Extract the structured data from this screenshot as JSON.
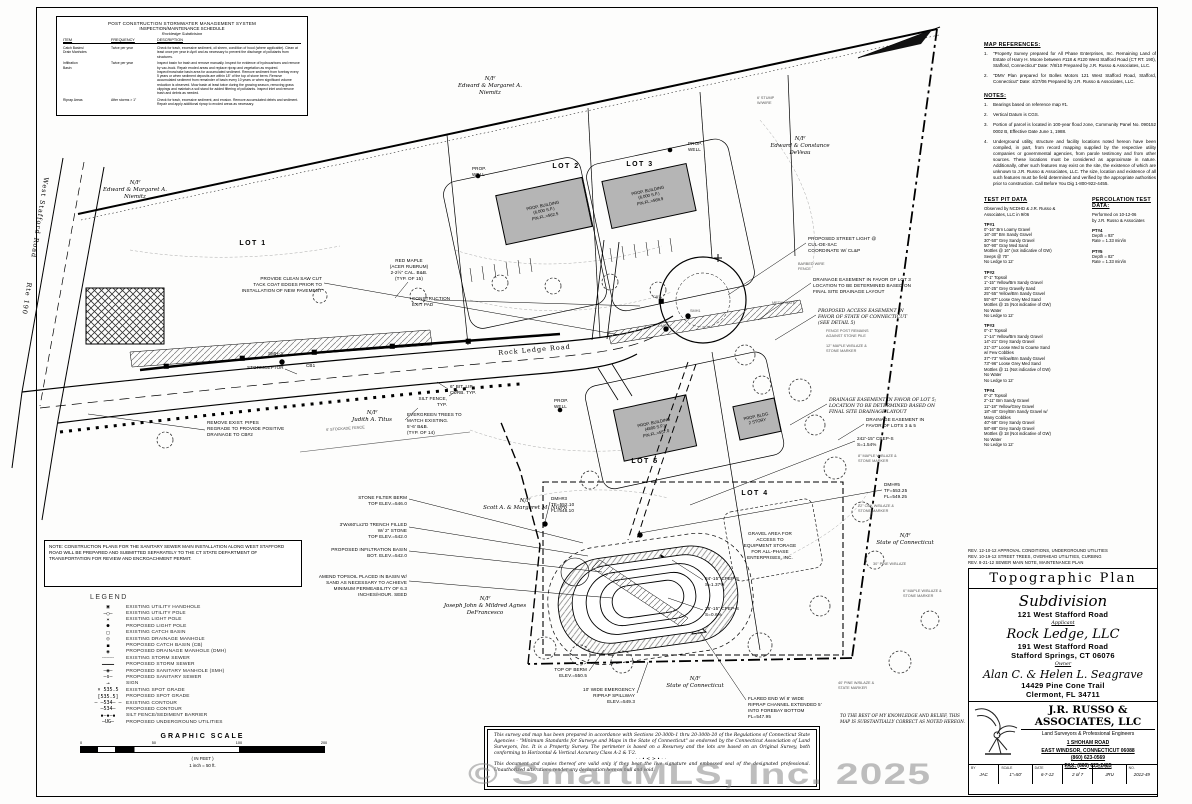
{
  "watermark": "© SmartMLS, Inc. 2025",
  "maintenance_table": {
    "title1": "POST CONSTRUCTION STORMWATER MANAGEMENT SYSTEM",
    "title2": "INSPECTION/MAINTENANCE SCHEDULE",
    "title3": "Rockledge Subdivision",
    "headers": [
      "ITEM",
      "FREQUENCY",
      "DESCRIPTION"
    ],
    "rows": [
      {
        "item": "Catch Basins/\nDrain Manholes",
        "frequency": "Twice per year",
        "description": "Check for trash, excessive sediment, oil sheen, condition of hood (where applicable). Clean at least once per year in April and as necessary to prevent the discharge of pollutants from structures."
      },
      {
        "item": "Infiltration\nBasin",
        "frequency": "Twice per year",
        "description": "Inspect basin for trash and remove manually. Inspect for evidence of hydrocarbons and remove by vac-truck. Repair eroded areas and replace riprap and vegetation as required. Inspect/mow/rake basin area for accumulated sediment. Remove sediment from forebay every 5 years or when sediment deposits are within 18\" of the top of stone berm. Remove accumulated sediment from remainder of basin every 10 years or when significant volume reduction is observed. Mow basin at least twice during the growing season, removing grass clippings and maintain a soil stand for added filtering of pollutants. Inspect inlet and remove trash and debris as needed."
      },
      {
        "item": "Riprap Areas",
        "frequency": "After storms > 1\"",
        "description": "Check for trash, excessive sediment, and erosion. Remove accumulated debris and sediment. Repair and apply additional riprap to eroded areas as necessary."
      }
    ]
  },
  "map_references": {
    "title": "MAP REFERENCES:",
    "items": [
      "\"Property Survey prepared for All Phase Enterprises, Inc. Remaining Land of Estate of Harry H. Moore between #118 & #120 West Stafford Road (CT RT. 190), Stafford, Connecticut\"  Date: 7/8/10  Prepared by J.R. Russo & Associates, LLC.",
      "\"DMV Plan prepared for Bolles Motors 121 West Stafford Road, Stafford, Connecticut\"  Date: 4/27/06  Prepared by J.R. Russo & Associates, LLC."
    ]
  },
  "notes": {
    "title": "NOTES:",
    "items": [
      "Bearings based on reference map #1.",
      "Vertical Datum is CGS.",
      "Portion of parcel is located in 100-year flood zone, Community Panel No. 090152 0002 B, Effective Date June 1, 1988.",
      "Underground utility, structure and facility locations noted hereon have been compiled, in part, from record mapping supplied by the respective utility companies or governmental agencies, from parole testimony and from other sources.  These locations must be considered as approximate in nature.  Additionally, other such features may exist on the site, the existence of which are unknown to J.R. Russo & Associates, LLC.  The size, location and existence of all such features must be field determined and verified by the appropriate authorities prior to construction.  Call Before You Dig 1-800-922-4455."
    ]
  },
  "test_pit": {
    "title": "TEST PIT DATA",
    "intro": "Observed by NCDHD & J.R. Russo &\nAssociates, LLC in 9/06",
    "pits": [
      {
        "name": "TP#1",
        "lines": "0\"-16\"  Brn Loamy Gravel\n16\"-30\"  Brn Sandy Gravel\n30\"-50\"  Grey Sandy Gravel\n50\"-90\"  Gray Med Sand\nMottles @ 16\" (not indicative of GW)\nSeeps @ 70\"\nNo Ledge to 12'"
      },
      {
        "name": "TP#2",
        "lines": "0\"-1\"  Topsoil\n1\"-15\"  Yellow/Brn Sandy Gravel\n15\"-25\"  Grey Gravelly Sand\n25\"-55\"  Yellow/Brn Sandy Gravel\n55\"-87\"  Loose Grey Med Sand\nMottles @ 15 (Not indicative of GW)\nNo Water\nNo Ledge to 12'"
      },
      {
        "name": "TP#3",
        "lines": "0\"-1\"  Topsoil\n1\"-14\"  Yellow/Brn Sandy Gravel\n14\"-21\"  Grey Sandy Gravel\n21\"-37\"  Loose Med to Coarse Sand\n           w/ Few Cobbles\n37\"-73\"  Yellow/Brn Sandy Gravel\n73\"-96\"  Loose Grey Med Sand\nMottles @ 11 (Not indicative of GW)\nNo Water\nNo Ledge to 12'"
      },
      {
        "name": "TP#4",
        "lines": "0\"-2\"  Topsoil\n2\"-11\"  Brn Sandy Gravel\n11\"-18\"  Yellow/Grey Gravel\n18\"-40\"  Grey/Brn Sandy Gravel w/\n           Many Cobbles\n40\"-58\"  Grey Sandy Gravel\n58\"-88\"  Grey Sandy Gravel\nMottles @ 18 (Not indicative of GW)\nNo Water\nNo Ledge to 12'"
      }
    ]
  },
  "perc_test": {
    "title": "PERCOLATION TEST DATA:",
    "intro": "Performed on 10-12-06\nby J.R. Russo & Associates",
    "tests": [
      {
        "name": "PT#4",
        "lines": "Depth = 93\"\nRate = 1.33 min/in"
      },
      {
        "name": "PT#5",
        "lines": "Depth = 82\"\nRate = 1.33 min/in"
      }
    ]
  },
  "revisions": [
    "REV. 12-10-12   APPROVAL CONDITIONS, UNDERGROUND UTILITIES",
    "REV. 10-19-12   STREET TREES, OVERHEAD UTILITIES, CURBING",
    "REV. 8-21-12   SEWER MAIN NOTE, MAINTENANCE PLAN"
  ],
  "title_block": {
    "plan_type": "Topographic Plan",
    "subdivision": "Subdivision",
    "address": "121 West Stafford Road",
    "applicant_label": "Applicant",
    "applicant_name": "Rock Ledge, LLC",
    "applicant_addr1": "191 West Stafford Road",
    "applicant_addr2": "Stafford Springs, CT 06076",
    "owner_label": "Owner",
    "owner_name": "Alan C. & Helen L. Seagrave",
    "owner_addr1": "14429 Pine Cone Trail",
    "owner_addr2": "Clermont, FL 34711",
    "firm_name": "J.R. RUSSO & ASSOCIATES, LLC",
    "firm_sub": "Land Surveyors & Professional Engineers",
    "firm_addr1": "1 SHOHAM ROAD",
    "firm_addr2": "EAST WINDSOR, CONNECTICUT 06088",
    "firm_phone": "(860) 623-0569",
    "firm_fax": "FAX: (860) 623-2485",
    "fields": [
      {
        "label": "BY",
        "value": "JAC"
      },
      {
        "label": "SCALE",
        "value": "1\"=50'"
      },
      {
        "label": "DATE",
        "value": "6-7-12"
      },
      {
        "label": "SHEET",
        "value": "2 of 7"
      },
      {
        "label": "CHECKED",
        "value": "JRU"
      },
      {
        "label": "NO.",
        "value": "2012-49"
      }
    ]
  },
  "note_box": "NOTE:  CONSTRUCTION PLANS FOR THE SANITARY SEWER MAIN INSTALLATION ALONG WEST STAFFORD ROAD WILL BE PREPARED AND SUBMITTED SEPARATELY TO THE CT STATE DEPARTMENT OF TRANSPORTATION FOR REVIEW AND ENCROACHMENT PERMIT.",
  "legend": {
    "title": "LEGEND",
    "items": [
      {
        "sym": "▣",
        "label": "EXISTING UTILITY HANDHOLE"
      },
      {
        "sym": "—○—",
        "label": "EXISTING UTILITY POLE"
      },
      {
        "sym": "✶",
        "label": "EXISTING LIGHT POLE"
      },
      {
        "sym": "●",
        "label": "PROPOSED LIGHT POLE"
      },
      {
        "sym": "□",
        "label": "EXISTING CATCH BASIN"
      },
      {
        "sym": "◎",
        "label": "EXISTING DRAINAGE MANHOLE"
      },
      {
        "sym": "◼",
        "label": "PROPOSED CATCH BASIN (CB)"
      },
      {
        "sym": "◉",
        "label": "PROPOSED DRAINAGE MANHOLE (DMH)"
      },
      {
        "sym": "┄┄┄┄",
        "label": "EXISTING STORM SEWER"
      },
      {
        "sym": "━━━━",
        "label": "PROPOSED STORM SEWER"
      },
      {
        "sym": "—◉—",
        "label": "PROPOSED SANITARY MANHOLE (SMH)"
      },
      {
        "sym": "—s—",
        "label": "PROPOSED SANITARY SEWER"
      },
      {
        "sym": "⊸",
        "label": "SIGN"
      },
      {
        "sym": "× 535.5",
        "label": "EXISTING SPOT GRADE"
      },
      {
        "sym": "[535.5]",
        "label": "PROPOSED SPOT GRADE"
      },
      {
        "sym": "–  –534–  –",
        "label": "EXISTING CONTOUR"
      },
      {
        "sym": "—534—",
        "label": "PROPOSED CONTOUR"
      },
      {
        "sym": "▪—▪—▪",
        "label": "SILT FENCE/SEDIMENT BARRIER"
      },
      {
        "sym": "—UG—",
        "label": "PROPOSED UNDERGROUND UTILITIES"
      }
    ]
  },
  "scale_bar": {
    "title": "GRAPHIC SCALE",
    "ticks": [
      {
        "p": 0,
        "v": "0"
      },
      {
        "p": 30,
        "v": "50"
      },
      {
        "p": 65,
        "v": "100"
      },
      {
        "p": 100,
        "v": "200"
      }
    ],
    "note1": "( IN FEET )",
    "note2": "1 inch = 50 ft."
  },
  "statement_box": {
    "para1": "This survey and map has been prepared in accordance with Sections 20-300b-1 thru 20-300b-20 of the Regulations of Connecticut State Agencies - \"Minimum Standards for Surveys and Maps in the State of Connecticut\" as endorsed by the Connecticut Association of Land Surveyors, Inc.  It is a Property Survey. The perimeter is based on a Resurvey and the lots are based on an Original Survey, both conforming to Horizontal & Vertical Accuracy Class A-2 & T-2.",
    "divider": "··•≺≻•··",
    "para2": "This document and copies thereof are valid only if they bear the live signature and embossed seal of the designated professional.  Unauthorized alterations render any declaration hereon null and void."
  },
  "plan": {
    "labels": [
      {
        "x": 50,
        "y": 178,
        "rot": 99,
        "cls": "road",
        "t": "West Stafford Road        Rte 190"
      },
      {
        "x": 135,
        "y": 180,
        "cls": "own c",
        "t": "N/F\nEdward & Margaret A.\nNiemitz"
      },
      {
        "x": 490,
        "y": 76,
        "cls": "own c",
        "t": "N/F\nEdward & Margaret A.\nNiemitz"
      },
      {
        "x": 800,
        "y": 136,
        "cls": "own c",
        "t": "N/F\nEdward & Constance\nDeVeau"
      },
      {
        "x": 372,
        "y": 410,
        "cls": "own c",
        "t": "N/F\nJudith A. Titus"
      },
      {
        "x": 525,
        "y": 498,
        "cls": "own c",
        "t": "N/F\nScott A. & Margaret M. Nigro"
      },
      {
        "x": 485,
        "y": 596,
        "cls": "own c",
        "t": "N/F\nJoseph John & Mildred Agnes\nDeFrancesco"
      },
      {
        "x": 695,
        "y": 676,
        "cls": "own c",
        "t": "N/F\nState of Connecticut"
      },
      {
        "x": 905,
        "y": 533,
        "cls": "own c",
        "t": "N/F\nState of Connecticut"
      },
      {
        "x": 253,
        "y": 240,
        "cls": "lot c",
        "t": "LOT 1"
      },
      {
        "x": 566,
        "y": 163,
        "cls": "lot c",
        "t": "LOT 2"
      },
      {
        "x": 640,
        "y": 161,
        "cls": "lot c",
        "t": "LOT 3"
      },
      {
        "x": 755,
        "y": 490,
        "cls": "lot c",
        "t": "LOT 4"
      },
      {
        "x": 645,
        "y": 458,
        "cls": "lot c",
        "t": "LOT 5"
      },
      {
        "x": 322,
        "y": 276,
        "cls": "ann r",
        "t": "PROVIDE CLEAN SAW CUT\nTACK COAT EDGES PRIOR TO\nINSTALLATION OF NEW PAVEMENT"
      },
      {
        "x": 409,
        "y": 258,
        "cls": "ann c",
        "t": "RED MAPLE\n(ACER RUBRUM)\n2-2½\" CAL. B&B.\n(TYP. OF 15)"
      },
      {
        "x": 412,
        "y": 296,
        "cls": "ann",
        "t": "CONSTRUCTION\nEXIT PAD"
      },
      {
        "x": 247,
        "y": 365,
        "cls": "ann",
        "t": "STORMCEPTOR"
      },
      {
        "x": 268,
        "y": 351,
        "cls": "ann",
        "t": "SMH-3"
      },
      {
        "x": 306,
        "y": 363,
        "cls": "ann",
        "t": "CB1"
      },
      {
        "x": 498,
        "y": 349,
        "rot": -5,
        "cls": "road",
        "t": "Rock Ledge Road"
      },
      {
        "x": 447,
        "y": 396,
        "cls": "ann r",
        "t": "SILT FENCE,\nTYP."
      },
      {
        "x": 450,
        "y": 384,
        "cls": "ann",
        "t": "6\" BIT. LIP\nCURB. TYP."
      },
      {
        "x": 407,
        "y": 412,
        "cls": "ann",
        "t": "EVERGREEN TREES TO\nMATCH EXISTING.\n5'-6' B&B.\n(TYP. OF 14)"
      },
      {
        "x": 207,
        "y": 420,
        "cls": "ann",
        "t": "REMOVE EXIST. PIPES\nREGRADE TO PROVIDE POSITIVE\nDRAINAGE TO CB#2"
      },
      {
        "x": 326,
        "y": 428,
        "rot": -4,
        "cls": "tiny",
        "t": "6' STOCKADE FENCE"
      },
      {
        "x": 407,
        "y": 495,
        "cls": "ann r",
        "t": "STONE FILTER BERM\nTOP ELEV.=546.0"
      },
      {
        "x": 551,
        "y": 496,
        "cls": "ann",
        "t": "DMH#3\nTF=552.10\nFL=548.10"
      },
      {
        "x": 407,
        "y": 522,
        "cls": "ann r",
        "t": "3'Wx60'Lx2'D TRENCH FILLED\nW/ 2\" STONE\nTOP ELEV.=542.0"
      },
      {
        "x": 407,
        "y": 547,
        "cls": "ann r",
        "t": "PROPOSED INFILTRATION BASIN\nBOT. ELEV.=542.0"
      },
      {
        "x": 407,
        "y": 574,
        "cls": "ann r",
        "t": "AMEND TOPSOIL PLACED IN BASIN W/\nSAND AS NECESSARY TO ACHIEVE\nMINIMUM PERMEABILITY OF 6.3\nINCHES/HOUR. SEED"
      },
      {
        "x": 587,
        "y": 667,
        "cls": "ann r",
        "t": "TOP OF BERM\nELEV.=550.5"
      },
      {
        "x": 635,
        "y": 687,
        "cls": "ann r",
        "t": "10' WIDE EMERGENCY\nRIPRAP SPILLWAY\nELEV.=549.3"
      },
      {
        "x": 748,
        "y": 696,
        "cls": "ann",
        "t": "FLARED END W/ 8' WIDE\nRIPRAP CHANNEL EXTENDED 5'\nINTO FOREBAY BOTTOM\nFL=547.95"
      },
      {
        "x": 840,
        "y": 713,
        "cls": "cert",
        "t": "TO THE BEST OF MY KNOWLEDGE AND BELIEF, THIS\nMAP IS SUBSTANTIALLY CORRECT AS NOTED HEREON."
      },
      {
        "x": 705,
        "y": 576,
        "cls": "ann",
        "t": "84'-15\" CPEP-S\nS=1.37%"
      },
      {
        "x": 705,
        "y": 606,
        "cls": "ann",
        "t": "25'-15\" CPEP-S\nS=0.6%"
      },
      {
        "x": 770,
        "y": 531,
        "cls": "ann c",
        "t": "GRAVEL AREA FOR\nACCESS TO\nEQUIPMENT STORAGE\nFOR ALL-PHASE\nENTERPRISES, INC."
      },
      {
        "x": 884,
        "y": 482,
        "cls": "ann",
        "t": "DMH#5\nTF=553.25\nFL=549.25"
      },
      {
        "x": 866,
        "y": 417,
        "cls": "ann",
        "t": "DRAINAGE EASEMENT IN\nFAVOR OF LOTS 3 & 5"
      },
      {
        "x": 857,
        "y": 436,
        "cls": "ann",
        "t": "242'-15\" CPEP-S\nS=1.54%"
      },
      {
        "x": 829,
        "y": 398,
        "cls": "ann-i",
        "t": "DRAINAGE EASEMENT IN FAVOR OF LOT 5;\nLOCATION TO BE DETERMINED BASED ON\nFINAL SITE DRAINAGE LAYOUT"
      },
      {
        "x": 808,
        "y": 236,
        "cls": "ann",
        "t": "PROPOSED STREET LIGHT @\nCUL-DE-SAC\nCOORDINATE W/ CL&P"
      },
      {
        "x": 813,
        "y": 277,
        "cls": "ann",
        "t": "DRAINAGE EASEMENT IN FAVOR OF LOT 3\nLOCATION TO BE DETERMINED BASED ON\nFINAL SITE DRAINAGE LAYOUT"
      },
      {
        "x": 818,
        "y": 309,
        "cls": "ann-i",
        "t": "PROPOSED ACCESS EASEMENT IN\nFAVOR OF STATE OF CONNECTICUT\n(SEE DETAIL 5)"
      },
      {
        "x": 772,
        "y": 301,
        "cls": "tiny",
        "t": "METAL GATE"
      },
      {
        "x": 798,
        "y": 262,
        "cls": "tiny",
        "t": "BARBED WIRE\nFENCE"
      },
      {
        "x": 826,
        "y": 329,
        "cls": "tiny",
        "t": "FENCE POST REMAINS\nAGAINST STONE PILE"
      },
      {
        "x": 826,
        "y": 344,
        "cls": "tiny",
        "t": "12\" MAPLE W/BLAZE &\nSTONE MARKER"
      },
      {
        "x": 858,
        "y": 454,
        "cls": "tiny",
        "t": "8\" MAPLE W/BLAZE &\nSTONE MARKER"
      },
      {
        "x": 858,
        "y": 504,
        "cls": "tiny",
        "t": "22\" OAK W/BLAZE &\nSTONE MARKER"
      },
      {
        "x": 873,
        "y": 562,
        "cls": "tiny",
        "t": "30\" PINE W/BLAZE"
      },
      {
        "x": 903,
        "y": 589,
        "cls": "tiny",
        "t": "6\" MAPLE W/BLAZE &\nSTONE MARKER"
      },
      {
        "x": 838,
        "y": 681,
        "cls": "tiny",
        "t": "40' PINE W/BLAZE &\nSTATE MARKER"
      },
      {
        "x": 757,
        "y": 96,
        "cls": "tiny",
        "t": "6' STUMP\nW/WIRE"
      },
      {
        "x": 472,
        "y": 166,
        "cls": "ann",
        "t": "PROP.\nWELL"
      },
      {
        "x": 688,
        "y": 141,
        "cls": "ann",
        "t": "PROP.\nWELL"
      },
      {
        "x": 554,
        "y": 398,
        "cls": "ann",
        "t": "PROP.\nWELL"
      },
      {
        "x": 653,
        "y": 295,
        "cls": "tiny",
        "t": "CB7"
      },
      {
        "x": 690,
        "y": 309,
        "cls": "tiny",
        "t": "SMH1"
      },
      {
        "x": 658,
        "y": 324,
        "cls": "tiny",
        "t": "DMH2"
      },
      {
        "x": 544,
        "y": 211,
        "rot": -12,
        "cls": "bldg cc",
        "t": "PROP. BUILDING\n(6,000 S.F.)\nFIN.FL.=562.5"
      },
      {
        "x": 649,
        "y": 196,
        "rot": -12,
        "cls": "bldg cc",
        "t": "PROP. BUILDING\n(6,000 S.F.)\nFIN.FL.=569.9"
      },
      {
        "x": 655,
        "y": 428,
        "rot": -12,
        "cls": "bldg cc",
        "t": "PROP. BUILDING\n(4800 S.F.)\nFIN.FL.=557.0"
      },
      {
        "x": 757,
        "y": 419,
        "rot": -12,
        "cls": "bldg cc",
        "t": "PROP. BLDG.\n2 STORY"
      }
    ]
  }
}
